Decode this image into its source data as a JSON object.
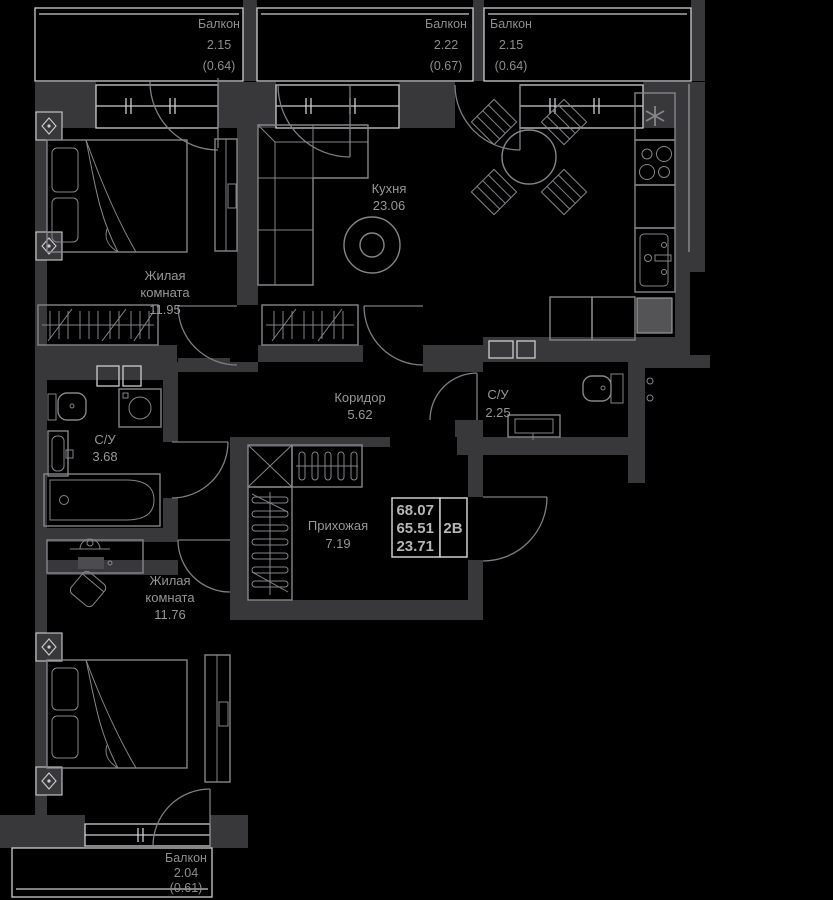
{
  "colors": {
    "background": "#000000",
    "wall": "#38383b",
    "window_outline": "#cdcdd0",
    "furniture_outline": "#85858a",
    "label_text": "#97979b",
    "info_text": "#b6b6b9"
  },
  "balconies": {
    "top_left": {
      "lines": [
        "Балкон",
        "2.15",
        "(0.64)"
      ]
    },
    "top_middle": {
      "lines": [
        "Балкон",
        "2.22",
        "(0.67)"
      ]
    },
    "top_right": {
      "lines": [
        "Балкон",
        "2.15",
        "(0.64)"
      ]
    },
    "bottom": {
      "lines": [
        "Балкон",
        "2.04",
        "(0.61)"
      ]
    }
  },
  "rooms": {
    "kitchen": {
      "lines": [
        "Кухня",
        "23.06"
      ]
    },
    "bedroom_top": {
      "lines": [
        "Жилая",
        "комната",
        "11.95"
      ]
    },
    "bedroom_bottom": {
      "lines": [
        "Жилая",
        "комната",
        "11.76"
      ]
    },
    "corridor": {
      "lines": [
        "Коридор",
        "5.62"
      ]
    },
    "hallway": {
      "lines": [
        "Прихожая",
        "7.19"
      ]
    },
    "bathroom_large": {
      "lines": [
        "С/У",
        "3.68"
      ]
    },
    "bathroom_small": {
      "lines": [
        "С/У",
        "2.25"
      ]
    }
  },
  "info_box": {
    "total_area": "68.07",
    "living_area": "65.51",
    "kitchen_area": "23.71",
    "unit_type": "2В"
  }
}
